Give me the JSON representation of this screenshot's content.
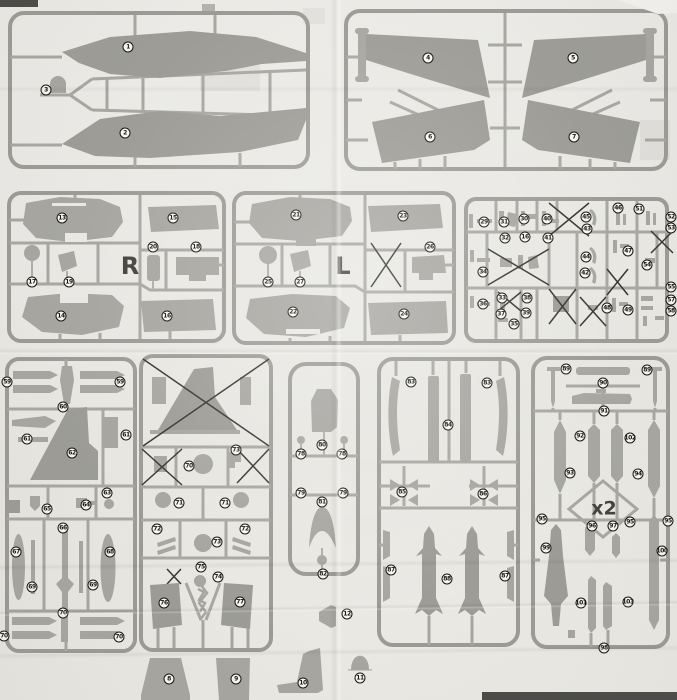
{
  "colors": {
    "paper": "#e9e8e4",
    "sprue_gray": "#9c9b96",
    "part_gray": "#a7a6a1",
    "ink": "#16150f",
    "dark_bar": "#4b4a48"
  },
  "sprues": [
    {
      "id": "top-left-wings",
      "labels": [
        [
          "1",
          128,
          47
        ],
        [
          "2",
          125,
          133
        ],
        [
          "3",
          46,
          90
        ]
      ]
    },
    {
      "id": "top-right-wings",
      "labels": [
        [
          "4",
          428,
          58
        ],
        [
          "5",
          573,
          58
        ],
        [
          "6",
          430,
          137
        ],
        [
          "7",
          574,
          137
        ]
      ]
    },
    {
      "id": "mid-left-R",
      "labels": [
        [
          "13",
          62,
          218
        ],
        [
          "15",
          173,
          218
        ],
        [
          "20",
          153,
          247
        ],
        [
          "18",
          196,
          247
        ],
        [
          "17",
          32,
          282
        ],
        [
          "19",
          69,
          282
        ],
        [
          "14",
          61,
          316
        ],
        [
          "16",
          167,
          316
        ]
      ]
    },
    {
      "id": "mid-center-L",
      "labels": [
        [
          "21",
          296,
          215
        ],
        [
          "23",
          403,
          216
        ],
        [
          "26",
          430,
          247
        ],
        [
          "25",
          268,
          282
        ],
        [
          "27",
          300,
          282
        ],
        [
          "22",
          293,
          312
        ],
        [
          "24",
          404,
          314
        ]
      ]
    },
    {
      "id": "mid-right-dense",
      "labels": [
        [
          "29",
          484,
          222
        ],
        [
          "31",
          504,
          222
        ],
        [
          "30",
          524,
          219
        ],
        [
          "40",
          547,
          219
        ],
        [
          "32",
          505,
          238
        ],
        [
          "16",
          525,
          237
        ],
        [
          "41",
          548,
          238
        ],
        [
          "45",
          586,
          217
        ],
        [
          "43",
          587,
          229
        ],
        [
          "46",
          618,
          208
        ],
        [
          "51",
          639,
          209
        ],
        [
          "52",
          671,
          217
        ],
        [
          "53",
          671,
          228
        ],
        [
          "44",
          586,
          257
        ],
        [
          "42",
          585,
          273
        ],
        [
          "47",
          628,
          251
        ],
        [
          "54",
          647,
          265
        ],
        [
          "34",
          483,
          272
        ],
        [
          "36",
          483,
          304
        ],
        [
          "33",
          502,
          298
        ],
        [
          "38",
          527,
          298
        ],
        [
          "37",
          501,
          314
        ],
        [
          "39",
          526,
          313
        ],
        [
          "35",
          514,
          324
        ],
        [
          "48",
          607,
          308
        ],
        [
          "49",
          628,
          310
        ],
        [
          "55",
          671,
          287
        ],
        [
          "57",
          671,
          300
        ],
        [
          "58",
          671,
          311
        ]
      ]
    },
    {
      "id": "bottom-1",
      "labels": [
        [
          "59",
          7,
          382
        ],
        [
          "59",
          120,
          382
        ],
        [
          "60",
          63,
          407
        ],
        [
          "61",
          27,
          439
        ],
        [
          "61",
          126,
          435
        ],
        [
          "62",
          72,
          453
        ],
        [
          "63",
          107,
          493
        ],
        [
          "64",
          86,
          505
        ],
        [
          "65",
          47,
          509
        ],
        [
          "66",
          63,
          528
        ],
        [
          "67",
          16,
          552
        ],
        [
          "68",
          110,
          552
        ],
        [
          "69",
          32,
          587
        ],
        [
          "69",
          93,
          585
        ],
        [
          "70",
          63,
          613
        ],
        [
          "70",
          4,
          636
        ],
        [
          "70",
          119,
          637
        ]
      ]
    },
    {
      "id": "bottom-2",
      "labels": [
        [
          "73",
          236,
          450
        ],
        [
          "70",
          189,
          466
        ],
        [
          "71",
          179,
          503
        ],
        [
          "71",
          225,
          503
        ],
        [
          "72",
          157,
          529
        ],
        [
          "72",
          245,
          529
        ],
        [
          "73",
          217,
          542
        ],
        [
          "75",
          201,
          567
        ],
        [
          "74",
          218,
          577
        ],
        [
          "76",
          164,
          603
        ],
        [
          "77",
          240,
          602
        ]
      ]
    },
    {
      "id": "bottom-3-canopy",
      "labels": [
        [
          "80",
          322,
          445
        ],
        [
          "78",
          301,
          454
        ],
        [
          "78",
          342,
          454
        ],
        [
          "79",
          301,
          493
        ],
        [
          "79",
          343,
          493
        ],
        [
          "81",
          322,
          502
        ],
        [
          "82",
          323,
          574
        ]
      ]
    },
    {
      "id": "bottom-4-missiles",
      "labels": [
        [
          "83",
          411,
          382
        ],
        [
          "83",
          487,
          383
        ],
        [
          "84",
          448,
          425
        ],
        [
          "85",
          402,
          492
        ],
        [
          "86",
          483,
          494
        ],
        [
          "87",
          391,
          570
        ],
        [
          "88",
          447,
          579
        ],
        [
          "87",
          505,
          576
        ]
      ]
    },
    {
      "id": "bottom-5-x2",
      "labels": [
        [
          "89",
          566,
          369
        ],
        [
          "89",
          647,
          370
        ],
        [
          "90",
          603,
          383
        ],
        [
          "91",
          604,
          411
        ],
        [
          "92",
          580,
          436
        ],
        [
          "102",
          630,
          438
        ],
        [
          "93",
          570,
          473
        ],
        [
          "94",
          638,
          474
        ],
        [
          "95",
          542,
          519
        ],
        [
          "96",
          592,
          526
        ],
        [
          "97",
          613,
          526
        ],
        [
          "95",
          630,
          522
        ],
        [
          "95",
          668,
          521
        ],
        [
          "99",
          546,
          548
        ],
        [
          "100",
          662,
          551
        ],
        [
          "101",
          581,
          603
        ],
        [
          "103",
          628,
          602
        ],
        [
          "98",
          604,
          648
        ]
      ]
    }
  ],
  "loose_labels": [
    [
      "12",
      347,
      614
    ],
    [
      "8",
      169,
      679
    ],
    [
      "9",
      236,
      679
    ],
    [
      "10",
      303,
      683
    ],
    [
      "11",
      360,
      678
    ]
  ],
  "letters": [
    [
      "R",
      130,
      266,
      24
    ],
    [
      "L",
      343,
      266,
      24
    ],
    [
      "x2",
      604,
      509,
      19
    ]
  ]
}
